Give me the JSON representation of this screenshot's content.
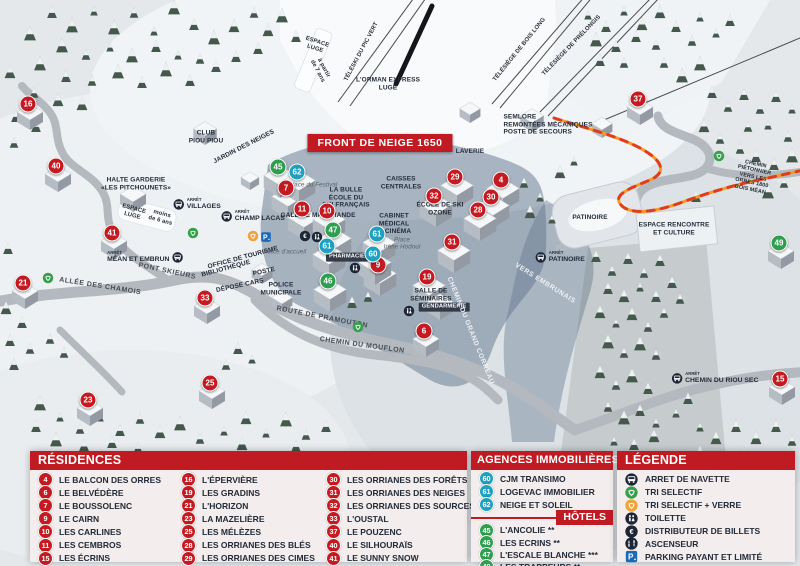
{
  "colors": {
    "res": "#c41a21",
    "hotel": "#2f9e4f",
    "agency": "#20a0bf",
    "header_red": "#c01b22",
    "dark": "#1d2637",
    "parking": "#1a6ab8",
    "recycle_green": "#35a14a",
    "recycle_yellow": "#f0a23c"
  },
  "map": {
    "title_box": "FRONT DE NEIGE 1650",
    "bus_prefix": "ARRÊT",
    "markers": [
      {
        "n": "16",
        "t": "res",
        "x": 28,
        "y": 104
      },
      {
        "n": "40",
        "t": "res",
        "x": 56,
        "y": 166
      },
      {
        "n": "41",
        "t": "res",
        "x": 112,
        "y": 233
      },
      {
        "n": "21",
        "t": "res",
        "x": 23,
        "y": 283
      },
      {
        "n": "33",
        "t": "res",
        "x": 205,
        "y": 298
      },
      {
        "n": "23",
        "t": "res",
        "x": 88,
        "y": 400
      },
      {
        "n": "25",
        "t": "res",
        "x": 210,
        "y": 383
      },
      {
        "n": "7",
        "t": "res",
        "x": 286,
        "y": 188
      },
      {
        "n": "11",
        "t": "res",
        "x": 302,
        "y": 209
      },
      {
        "n": "10",
        "t": "res",
        "x": 327,
        "y": 211
      },
      {
        "n": "9",
        "t": "res",
        "x": 378,
        "y": 265
      },
      {
        "n": "29",
        "t": "res",
        "x": 455,
        "y": 177
      },
      {
        "n": "32",
        "t": "res",
        "x": 434,
        "y": 196
      },
      {
        "n": "4",
        "t": "res",
        "x": 501,
        "y": 180
      },
      {
        "n": "30",
        "t": "res",
        "x": 491,
        "y": 197
      },
      {
        "n": "28",
        "t": "res",
        "x": 478,
        "y": 210
      },
      {
        "n": "31",
        "t": "res",
        "x": 452,
        "y": 242
      },
      {
        "n": "19",
        "t": "res",
        "x": 427,
        "y": 277
      },
      {
        "n": "6",
        "t": "res",
        "x": 424,
        "y": 331
      },
      {
        "n": "37",
        "t": "res",
        "x": 638,
        "y": 99
      },
      {
        "n": "15",
        "t": "res",
        "x": 780,
        "y": 379
      },
      {
        "n": "45",
        "t": "hotel",
        "x": 278,
        "y": 167
      },
      {
        "n": "47",
        "t": "hotel",
        "x": 333,
        "y": 230
      },
      {
        "n": "46",
        "t": "hotel",
        "x": 328,
        "y": 281
      },
      {
        "n": "49",
        "t": "hotel",
        "x": 779,
        "y": 243
      },
      {
        "n": "62",
        "t": "agency",
        "x": 297,
        "y": 172
      },
      {
        "n": "61",
        "t": "agency",
        "x": 327,
        "y": 246
      },
      {
        "n": "61",
        "t": "agency",
        "x": 377,
        "y": 234
      },
      {
        "n": "60",
        "t": "agency",
        "x": 373,
        "y": 254
      }
    ],
    "bus_stops": [
      {
        "name": "VILLAGES",
        "x": 197,
        "y": 204
      },
      {
        "name": "CHAMP LACAS",
        "x": 253,
        "y": 216
      },
      {
        "name": "MÉAN ET EMBRUN",
        "x": 145,
        "y": 257,
        "side": "right"
      },
      {
        "name": "PATINOIRE",
        "x": 560,
        "y": 257
      },
      {
        "name": "CHEMIN DU RIOU SEC",
        "x": 715,
        "y": 378
      }
    ],
    "icons": [
      {
        "type": "recycle-green",
        "x": 48,
        "y": 278
      },
      {
        "type": "recycle-green",
        "x": 193,
        "y": 233
      },
      {
        "type": "recycle-green",
        "x": 358,
        "y": 327
      },
      {
        "type": "recycle-green",
        "x": 719,
        "y": 156
      },
      {
        "type": "recycle-yellow",
        "x": 253,
        "y": 236
      },
      {
        "type": "parking",
        "x": 266,
        "y": 237
      },
      {
        "type": "euro",
        "x": 305,
        "y": 236
      },
      {
        "type": "toilet",
        "x": 317,
        "y": 237
      },
      {
        "type": "toilet",
        "x": 355,
        "y": 268
      },
      {
        "type": "toilet",
        "x": 409,
        "y": 311
      }
    ],
    "labels": [
      {
        "text": "ESPACE\nLUGE",
        "x": 316,
        "y": 46,
        "cls": "lift",
        "rot": 18
      },
      {
        "text": "à partir\nde 7 ans",
        "x": 320,
        "y": 70,
        "cls": "lift",
        "rot": 62
      },
      {
        "text": "L'ORMAN EXPRESS\nLUGE",
        "x": 388,
        "y": 84,
        "cls": "place-sm"
      },
      {
        "text": "TÉLÉSKI DU PIC VERT",
        "x": 362,
        "y": 52,
        "cls": "lift",
        "rot": -62
      },
      {
        "text": "TÉLÉSIÈGE DE BOIS LONG",
        "x": 520,
        "y": 50,
        "cls": "lift",
        "rot": -51
      },
      {
        "text": "TÉLÉSIÈGE DE PRÉLONGIS",
        "x": 572,
        "y": 46,
        "cls": "lift",
        "rot": -46
      },
      {
        "text": "SEMLORE\nREMONTÉES MÉCANIQUES\nPOSTE DE SECOURS",
        "x": 548,
        "y": 125,
        "cls": "place-sm left"
      },
      {
        "text": "CLUB\nPIOU PIOU",
        "x": 206,
        "y": 137,
        "cls": "place-sm"
      },
      {
        "text": "JARDIN DES NEIGES",
        "x": 244,
        "y": 147,
        "cls": "place-sm",
        "rot": -27
      },
      {
        "text": "HALTE GARDERIE\n«LES PITCHOUNETS»",
        "x": 136,
        "y": 184,
        "cls": "place-sm"
      },
      {
        "text": "ESPACE\nLUGE",
        "x": 133,
        "y": 213,
        "cls": "lift",
        "rot": 15
      },
      {
        "text": "moins\nde 6 ans",
        "x": 161,
        "y": 218,
        "cls": "lift",
        "rot": 15
      },
      {
        "text": "VILLAGES",
        "x": 197,
        "y": 204,
        "cls": "skip"
      },
      {
        "text": "LAVERIE",
        "x": 470,
        "y": 152,
        "cls": "place-sm"
      },
      {
        "text": "CAISSES\nCENTRALES",
        "x": 401,
        "y": 183,
        "cls": "place-sm"
      },
      {
        "text": "LA BULLE\nÉCOLE DU\nSKI FRANÇAIS",
        "x": 346,
        "y": 198,
        "cls": "place-sm"
      },
      {
        "text": "Place du Festival",
        "x": 313,
        "y": 185,
        "cls": "italic"
      },
      {
        "text": "GALERIE MARCHANDE",
        "x": 318,
        "y": 216,
        "cls": "place-sm"
      },
      {
        "text": "ÉCOLE DE SKI\nOZONE",
        "x": 440,
        "y": 209,
        "cls": "place-sm"
      },
      {
        "text": "CABINET\nMÉDICAL",
        "x": 394,
        "y": 220,
        "cls": "place-sm"
      },
      {
        "text": "CINÉMA",
        "x": 398,
        "y": 232,
        "cls": "place-sm"
      },
      {
        "text": "Place\nIrène Hodoul",
        "x": 402,
        "y": 244,
        "cls": "italic"
      },
      {
        "text": "OFFICE DE TOURISME",
        "x": 243,
        "y": 258,
        "cls": "place-sm",
        "rot": -15
      },
      {
        "text": "BIBLIOTHÈQUE",
        "x": 226,
        "y": 269,
        "cls": "place-sm",
        "rot": -15
      },
      {
        "text": "POSTE",
        "x": 264,
        "y": 272,
        "cls": "place-sm",
        "rot": -12
      },
      {
        "text": "DÉPOSE CARS",
        "x": 240,
        "y": 286,
        "cls": "place-sm",
        "rot": -12
      },
      {
        "text": "POLICE\nMUNICIPALE",
        "x": 281,
        "y": 289,
        "cls": "place-sm"
      },
      {
        "text": "Place d'accueil",
        "x": 285,
        "y": 252,
        "cls": "italic"
      },
      {
        "text": "PHARMACIE",
        "x": 347,
        "y": 257,
        "cls": "dark-box"
      },
      {
        "text": "SALLE DE\nSÉMINAIRES",
        "x": 431,
        "y": 295,
        "cls": "place-sm"
      },
      {
        "text": "GENDARMERIE",
        "x": 444,
        "y": 307,
        "cls": "dark-box"
      },
      {
        "text": "PATINOIRE",
        "x": 590,
        "y": 218,
        "cls": "place-sm"
      },
      {
        "text": "ESPACE RENCONTRE\nET CULTURE",
        "x": 674,
        "y": 229,
        "cls": "place-sm"
      },
      {
        "text": "VERS EMBRUNAIS",
        "x": 545,
        "y": 284,
        "cls": "road-white",
        "rot": 32
      },
      {
        "text": "CHEMIN DU GRAND CORREAU",
        "x": 470,
        "y": 331,
        "cls": "road-white",
        "rot": 68
      },
      {
        "text": "ROUTE DE PRAMOUTON",
        "x": 322,
        "y": 318,
        "cls": "road",
        "rot": 11
      },
      {
        "text": "CHEMIN DU MOUFLON",
        "x": 362,
        "y": 346,
        "cls": "road",
        "rot": 8
      },
      {
        "text": "ALLÉE DES CHAMOIS",
        "x": 100,
        "y": 287,
        "cls": "road",
        "rot": 9
      },
      {
        "text": "PONT SKIEURS",
        "x": 167,
        "y": 272,
        "cls": "road",
        "rot": 12
      },
      {
        "text": "CHEMIN PIÉTONNIER\nVERS LES ORRES 1800\nBOIS MÉAN",
        "x": 753,
        "y": 177,
        "cls": "tiny",
        "rot": 12
      }
    ]
  },
  "panels": {
    "residences": {
      "title": "RÉSIDENCES",
      "items": [
        {
          "n": "4",
          "label": "LE BALCON DES ORRES"
        },
        {
          "n": "6",
          "label": "LE BELVÉDÈRE"
        },
        {
          "n": "7",
          "label": "LE BOUSSOLENC"
        },
        {
          "n": "9",
          "label": "LE CAIRN"
        },
        {
          "n": "10",
          "label": "LES CARLINES"
        },
        {
          "n": "11",
          "label": "LES CEMBROS"
        },
        {
          "n": "15",
          "label": "LES ÉCRINS"
        },
        {
          "n": "16",
          "label": "L'ÉPERVIÈRE"
        },
        {
          "n": "19",
          "label": "LES GRADINS"
        },
        {
          "n": "21",
          "label": "L'HORIZON"
        },
        {
          "n": "23",
          "label": "LA MAZELIÈRE"
        },
        {
          "n": "25",
          "label": "LES MÉLÈZES"
        },
        {
          "n": "28",
          "label": "LES ORRIANES DES BLÉS"
        },
        {
          "n": "29",
          "label": "LES ORRIANES DES CIMES"
        },
        {
          "n": "30",
          "label": "LES ORRIANES DES FORÊTS"
        },
        {
          "n": "31",
          "label": "LES ORRIANES DES NEIGES"
        },
        {
          "n": "32",
          "label": "LES ORRIANES DES SOURCES"
        },
        {
          "n": "33",
          "label": "L'OUSTAL"
        },
        {
          "n": "37",
          "label": "LE POUZENC"
        },
        {
          "n": "40",
          "label": "LE SILHOURAÏS"
        },
        {
          "n": "41",
          "label": "LE SUNNY SNOW"
        }
      ]
    },
    "agences": {
      "title": "AGENCES IMMOBILIÈRES",
      "items": [
        {
          "n": "60",
          "label": "CJM TRANSIMO"
        },
        {
          "n": "61",
          "label": "LOGEVAC IMMOBILIER"
        },
        {
          "n": "62",
          "label": "NEIGE ET SOLEIL"
        }
      ]
    },
    "hotels": {
      "title": "HÔTELS",
      "items": [
        {
          "n": "45",
          "label": "L'ANCOLIE **"
        },
        {
          "n": "46",
          "label": "LES ECRINS **"
        },
        {
          "n": "47",
          "label": "L'ESCALE BLANCHE ***"
        },
        {
          "n": "49",
          "label": "LES TRAPPEURS **"
        }
      ]
    },
    "legende": {
      "title": "LÉGENDE",
      "items": [
        {
          "icon": "bus",
          "label": "ARRET DE NAVETTE"
        },
        {
          "icon": "recycle-green",
          "label": "TRI SELECTIF"
        },
        {
          "icon": "recycle-yellow",
          "label": "TRI SELECTIF + VERRE"
        },
        {
          "icon": "toilet",
          "label": "TOILETTE"
        },
        {
          "icon": "euro",
          "label": "DISTRIBUTEUR DE BILLETS"
        },
        {
          "icon": "elevator",
          "label": "ASCENSEUR"
        },
        {
          "icon": "parking",
          "label": "PARKING PAYANT ET LIMITÉ"
        }
      ]
    }
  }
}
